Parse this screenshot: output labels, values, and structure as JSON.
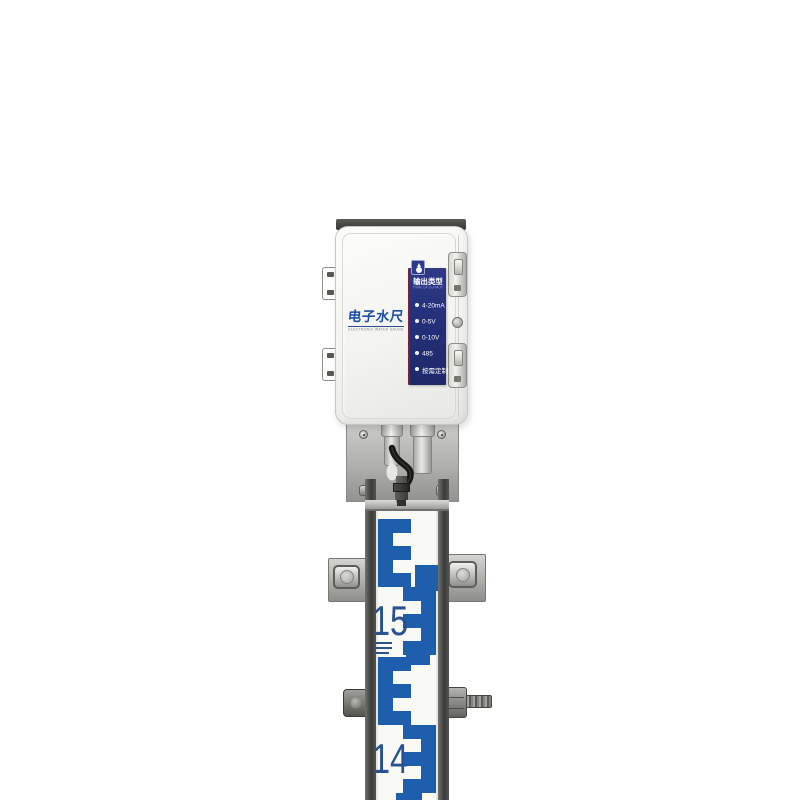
{
  "photo": {
    "device": {
      "brand_title": "电子水尺",
      "brand_subtitle": "ELECTRONIC WATER GAUGE",
      "output_panel": {
        "header": "输出类型",
        "subheader": "TYPE OF OUTPUT",
        "items": [
          {
            "label": "4-20mA"
          },
          {
            "label": "0-5V"
          },
          {
            "label": "0-10V"
          },
          {
            "label": "485"
          },
          {
            "label": "按需定制"
          }
        ]
      }
    },
    "gauge": {
      "upper_number": "15",
      "lower_number": "14"
    },
    "colors": {
      "gauge_blue": "#1f5ead",
      "number_blue": "#2a5191",
      "panel_navy": "#232e78",
      "panel_accent_red": "#7c2133",
      "brand_blue": "#1a4fa2"
    }
  }
}
